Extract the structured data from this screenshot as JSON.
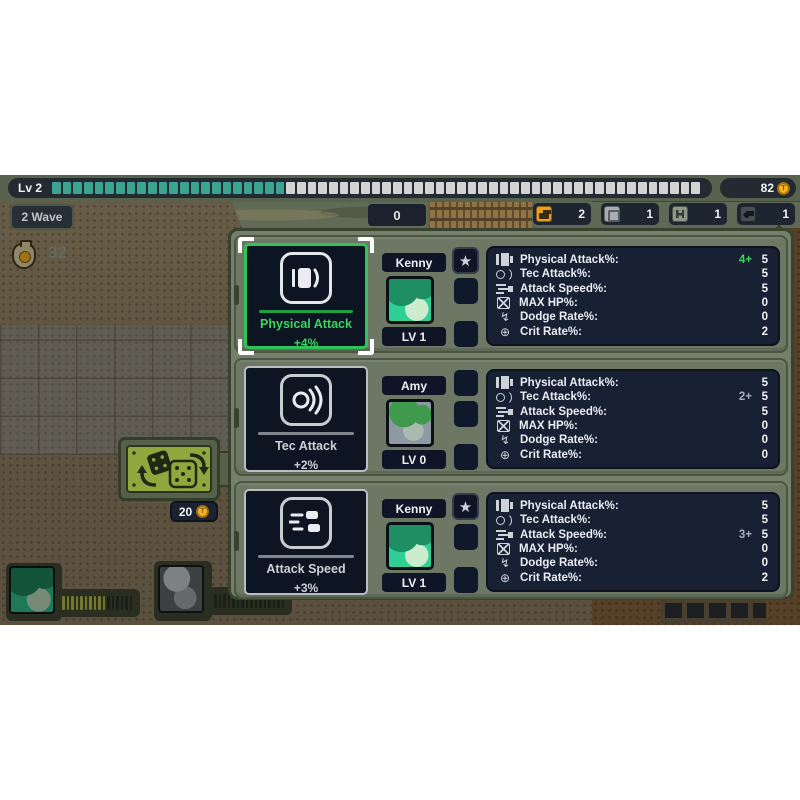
{
  "hud": {
    "level_label": "Lv 2",
    "level_segments_total": 61,
    "level_segments_filled": 22,
    "coins": "82",
    "wave_label": "2 Wave",
    "counter": "0",
    "money": "32",
    "reroll_cost": "20",
    "item_slots": [
      {
        "icon": "tank-icon",
        "count": "2"
      },
      {
        "icon": "crate-icon",
        "count": "1"
      },
      {
        "icon": "barbell-icon",
        "count": "1"
      },
      {
        "icon": "pistol-icon",
        "count": "1"
      }
    ]
  },
  "upgrade_rows": [
    {
      "selected": true,
      "card": {
        "title": "Physical Attack",
        "bonus": "+4%",
        "icon": "machine-gun-icon"
      },
      "unit": {
        "name": "Kenny",
        "level": "LV 1",
        "starred": true
      },
      "stats": [
        {
          "icon": "physical-attack-icon",
          "label": "Physical Attack%:",
          "bonus": "4+",
          "value": "5"
        },
        {
          "icon": "tec-attack-icon",
          "label": "Tec Attack%:",
          "bonus": "",
          "value": "5"
        },
        {
          "icon": "attack-speed-icon",
          "label": "Attack Speed%:",
          "bonus": "",
          "value": "5"
        },
        {
          "icon": "max-hp-icon",
          "label": "MAX HP%:",
          "bonus": "",
          "value": "0"
        },
        {
          "icon": "dodge-icon",
          "label": "Dodge Rate%:",
          "bonus": "",
          "value": "0"
        },
        {
          "icon": "crit-icon",
          "label": "Crit Rate%:",
          "bonus": "",
          "value": "2"
        }
      ]
    },
    {
      "selected": false,
      "card": {
        "title": "Tec Attack",
        "bonus": "+2%",
        "icon": "tec-waves-icon"
      },
      "unit": {
        "name": "Amy",
        "level": "LV 0",
        "starred": false
      },
      "stats": [
        {
          "icon": "physical-attack-icon",
          "label": "Physical Attack%:",
          "bonus": "",
          "value": "5"
        },
        {
          "icon": "tec-attack-icon",
          "label": "Tec Attack%:",
          "bonus": "2+",
          "value": "5"
        },
        {
          "icon": "attack-speed-icon",
          "label": "Attack Speed%:",
          "bonus": "",
          "value": "5"
        },
        {
          "icon": "max-hp-icon",
          "label": "MAX HP%:",
          "bonus": "",
          "value": "0"
        },
        {
          "icon": "dodge-icon",
          "label": "Dodge Rate%:",
          "bonus": "",
          "value": "0"
        },
        {
          "icon": "crit-icon",
          "label": "Crit Rate%:",
          "bonus": "",
          "value": "0"
        }
      ]
    },
    {
      "selected": false,
      "card": {
        "title": "Attack Speed",
        "bonus": "+3%",
        "icon": "speed-lines-icon"
      },
      "unit": {
        "name": "Kenny",
        "level": "LV 1",
        "starred": true
      },
      "stats": [
        {
          "icon": "physical-attack-icon",
          "label": "Physical Attack%:",
          "bonus": "",
          "value": "5"
        },
        {
          "icon": "tec-attack-icon",
          "label": "Tec Attack%:",
          "bonus": "",
          "value": "5"
        },
        {
          "icon": "attack-speed-icon",
          "label": "Attack Speed%:",
          "bonus": "3+",
          "value": "5"
        },
        {
          "icon": "max-hp-icon",
          "label": "MAX HP%:",
          "bonus": "",
          "value": "0"
        },
        {
          "icon": "dodge-icon",
          "label": "Dodge Rate%:",
          "bonus": "",
          "value": "0"
        },
        {
          "icon": "crit-icon",
          "label": "Crit Rate%:",
          "bonus": "",
          "value": "2"
        }
      ]
    }
  ],
  "party": [
    {
      "name": "kenny",
      "bar_total": 16,
      "bar_filled": 10
    },
    {
      "name": "amy",
      "bar_total": 16,
      "bar_filled": 0
    }
  ],
  "colors": {
    "accent_green": "#3bd45f",
    "teal_fill": "#3aa491",
    "segment_empty": "#d3d3d3",
    "coin_gold": "#f2b41e",
    "bonus_gray": "#a9afbd",
    "panel_olive": "#747f6c",
    "stats_navy": "#182034"
  }
}
